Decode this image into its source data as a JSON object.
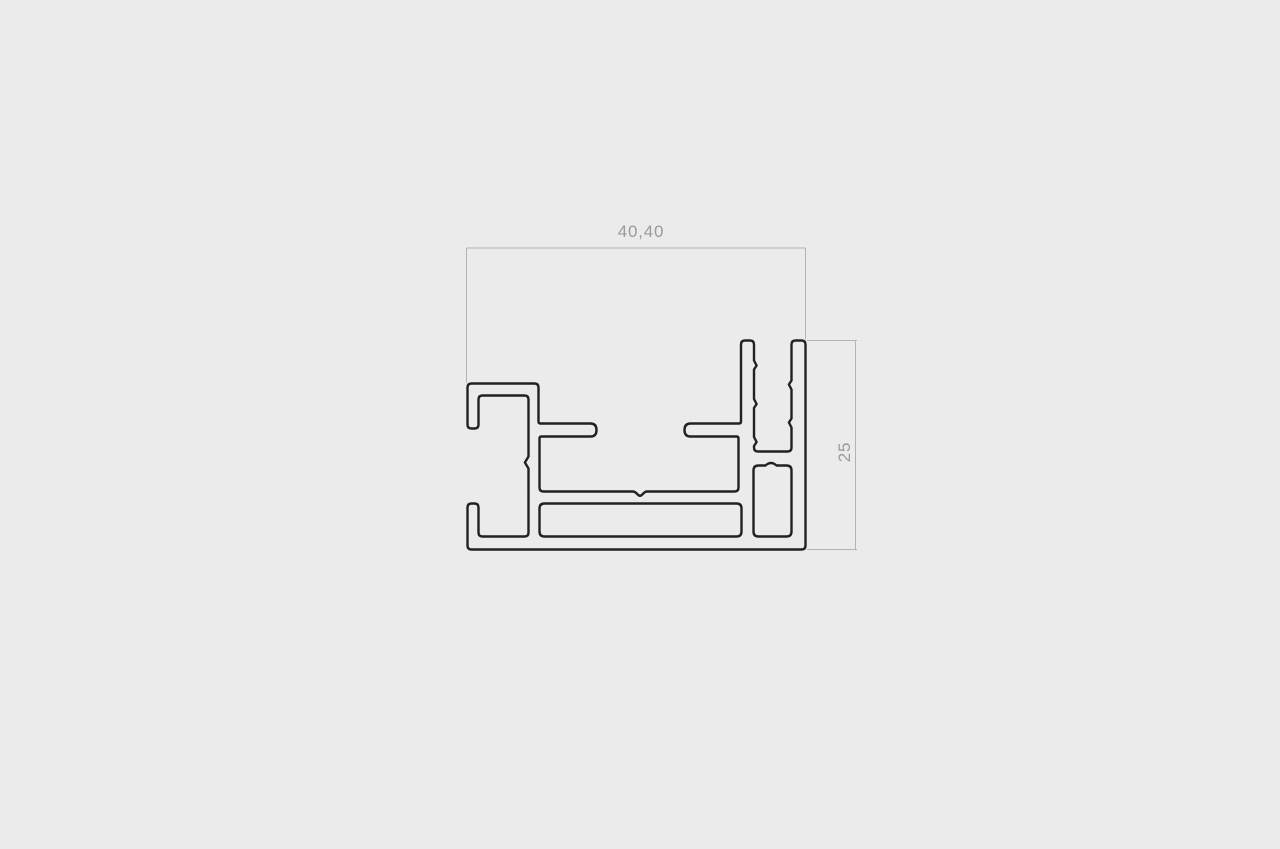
{
  "page": {
    "background_color": "#EBEBEB"
  },
  "drawing": {
    "name": "aluminium-profile-cross-section",
    "outline_color": "#212121",
    "dimension_line_color": "#B3B3B3",
    "dimension_text_color": "#9A9A9A",
    "dimensions": {
      "width": {
        "label": "40,40",
        "orientation": "horizontal"
      },
      "height": {
        "label": "25",
        "orientation": "vertical"
      }
    }
  }
}
